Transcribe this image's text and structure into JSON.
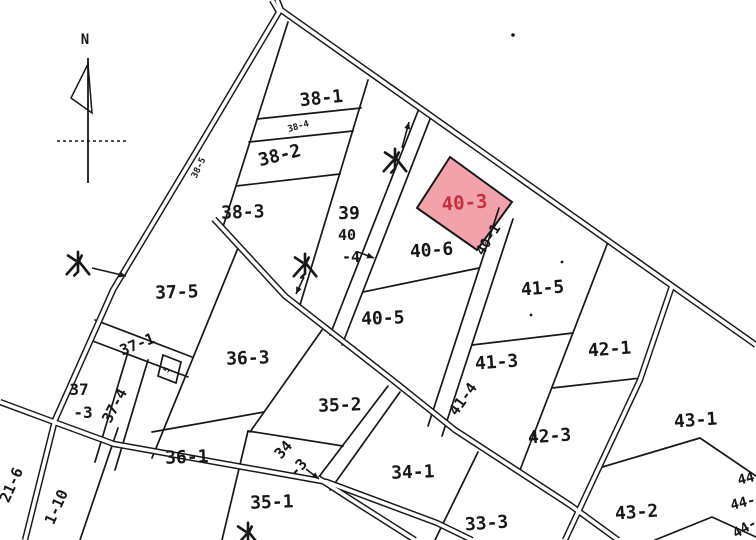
{
  "canvas": {
    "width": 756,
    "height": 540,
    "bg": "#ffffff",
    "ink": "#171717"
  },
  "compass": {
    "label": "N",
    "x": 85,
    "y": 44,
    "vline": [
      [
        88,
        58
      ],
      [
        88,
        183
      ]
    ],
    "flag": [
      [
        88,
        64
      ],
      [
        71,
        98
      ],
      [
        92,
        113
      ]
    ],
    "dash": [
      [
        57,
        141
      ],
      [
        127,
        141
      ]
    ]
  },
  "highlight": {
    "label": "40-3",
    "fill": "#F2A2AB",
    "stroke": "#171717",
    "text_color": "#C4303E",
    "polygon": [
      [
        450,
        157
      ],
      [
        512,
        202
      ],
      [
        477,
        250
      ],
      [
        417,
        208
      ]
    ],
    "label_x": 465,
    "label_y": 209,
    "label_rot": -4,
    "label_size": 19
  },
  "parcel_labels": [
    {
      "text": "38-1",
      "x": 322,
      "y": 104,
      "rot": -6,
      "size": 18
    },
    {
      "text": "38-4",
      "x": 299,
      "y": 129,
      "rot": -16,
      "size": 9
    },
    {
      "text": "38-2",
      "x": 281,
      "y": 161,
      "rot": -14,
      "size": 18
    },
    {
      "text": "38-3",
      "x": 243,
      "y": 218,
      "rot": -2,
      "size": 18
    },
    {
      "text": "38-5",
      "x": 201,
      "y": 169,
      "rot": -64,
      "size": 9
    },
    {
      "text": "39",
      "x": 349,
      "y": 219,
      "rot": 0,
      "size": 18
    },
    {
      "text": "40",
      "x": 347,
      "y": 240,
      "rot": 0,
      "size": 15
    },
    {
      "text": "-4",
      "x": 351,
      "y": 262,
      "rot": 0,
      "size": 15
    },
    {
      "text": "40-6",
      "x": 432,
      "y": 256,
      "rot": -4,
      "size": 18
    },
    {
      "text": "40-5",
      "x": 383,
      "y": 324,
      "rot": -2,
      "size": 18
    },
    {
      "text": "40-1",
      "x": 492,
      "y": 242,
      "rot": -58,
      "size": 14
    },
    {
      "text": "41-5",
      "x": 543,
      "y": 294,
      "rot": -4,
      "size": 18
    },
    {
      "text": "41-3",
      "x": 497,
      "y": 368,
      "rot": -4,
      "size": 18
    },
    {
      "text": "41-4",
      "x": 467,
      "y": 402,
      "rot": -54,
      "size": 15
    },
    {
      "text": "42-1",
      "x": 610,
      "y": 355,
      "rot": -4,
      "size": 18
    },
    {
      "text": "42-3",
      "x": 550,
      "y": 442,
      "rot": -4,
      "size": 18
    },
    {
      "text": "43-1",
      "x": 696,
      "y": 426,
      "rot": -4,
      "size": 18
    },
    {
      "text": "43-2",
      "x": 637,
      "y": 518,
      "rot": -4,
      "size": 18
    },
    {
      "text": "33-3",
      "x": 487,
      "y": 529,
      "rot": -4,
      "size": 18
    },
    {
      "text": "34-1",
      "x": 413,
      "y": 478,
      "rot": -2,
      "size": 18
    },
    {
      "text": "34",
      "x": 287,
      "y": 453,
      "rot": -48,
      "size": 15
    },
    {
      "text": "-3",
      "x": 302,
      "y": 471,
      "rot": -48,
      "size": 15
    },
    {
      "text": "35-2",
      "x": 340,
      "y": 411,
      "rot": -2,
      "size": 18
    },
    {
      "text": "35-1",
      "x": 272,
      "y": 508,
      "rot": -2,
      "size": 18
    },
    {
      "text": "36-3",
      "x": 248,
      "y": 364,
      "rot": -2,
      "size": 18
    },
    {
      "text": "36-1",
      "x": 187,
      "y": 463,
      "rot": -2,
      "size": 18
    },
    {
      "text": "37-5",
      "x": 177,
      "y": 298,
      "rot": -2,
      "size": 18
    },
    {
      "text": "37",
      "x": 79,
      "y": 395,
      "rot": 0,
      "size": 16
    },
    {
      "text": "-3",
      "x": 83,
      "y": 418,
      "rot": 0,
      "size": 16
    },
    {
      "text": "37-1",
      "x": 139,
      "y": 349,
      "rot": -22,
      "size": 15
    },
    {
      "text": "37-4",
      "x": 119,
      "y": 408,
      "rot": -62,
      "size": 15
    },
    {
      "text": "21-6",
      "x": 16,
      "y": 487,
      "rot": -66,
      "size": 15
    },
    {
      "text": "1-10",
      "x": 61,
      "y": 509,
      "rot": -66,
      "size": 15
    },
    {
      "text": "5",
      "x": 169,
      "y": 371,
      "rot": -60,
      "size": 8
    },
    {
      "text": "44",
      "x": 747,
      "y": 483,
      "rot": -14,
      "size": 14
    },
    {
      "text": "44-",
      "x": 744,
      "y": 507,
      "rot": -14,
      "size": 14
    },
    {
      "text": "44-",
      "x": 747,
      "y": 532,
      "rot": -30,
      "size": 14
    }
  ],
  "water_labels": [
    {
      "char": "水",
      "meaning": "water",
      "x": 395,
      "y": 160,
      "size": 1.25
    },
    {
      "char": "水",
      "meaning": "water",
      "x": 78,
      "y": 263,
      "size": 1.25
    },
    {
      "char": "水",
      "meaning": "water",
      "x": 305,
      "y": 265,
      "size": 1.25
    },
    {
      "char": "水",
      "meaning": "water",
      "x": 248,
      "y": 534,
      "size": 1.25
    }
  ],
  "channels": [
    {
      "name": "main-road-upper",
      "points": [
        [
          277,
          0
        ],
        [
          281,
          10
        ],
        [
          756,
          345
        ]
      ]
    },
    {
      "name": "left-channel",
      "points": [
        [
          272,
          0
        ],
        [
          279,
          12
        ],
        [
          197,
          150
        ],
        [
          113,
          290
        ],
        [
          55,
          420
        ],
        [
          25,
          540
        ]
      ]
    },
    {
      "name": "middle-channel",
      "points": [
        [
          214,
          219
        ],
        [
          285,
          296
        ],
        [
          390,
          378
        ],
        [
          455,
          430
        ],
        [
          570,
          505
        ],
        [
          618,
          540
        ]
      ]
    },
    {
      "name": "lower-left-channel",
      "points": [
        [
          0,
          402
        ],
        [
          54,
          422
        ],
        [
          114,
          444
        ],
        [
          327,
          482
        ],
        [
          437,
          523
        ],
        [
          472,
          540
        ]
      ]
    },
    {
      "name": "right-branch-road",
      "points": [
        [
          672,
          286
        ],
        [
          640,
          380
        ],
        [
          565,
          540
        ]
      ]
    },
    {
      "name": "bottom-center-channel",
      "points": [
        [
          318,
          478
        ],
        [
          352,
          500
        ],
        [
          415,
          540
        ]
      ]
    }
  ],
  "boundaries": [
    {
      "name": "b38-left",
      "points": [
        [
          288,
          22
        ],
        [
          222,
          230
        ]
      ]
    },
    {
      "name": "b38-39",
      "points": [
        [
          368,
          80
        ],
        [
          300,
          305
        ]
      ]
    },
    {
      "name": "strip40-4-left",
      "points": [
        [
          420,
          106
        ],
        [
          330,
          335
        ]
      ]
    },
    {
      "name": "strip40-4-right",
      "points": [
        [
          432,
          114
        ],
        [
          342,
          345
        ]
      ]
    },
    {
      "name": "strip40-1-left",
      "points": [
        [
          499,
          208
        ],
        [
          428,
          426
        ]
      ]
    },
    {
      "name": "strip40-1-right",
      "points": [
        [
          513,
          219
        ],
        [
          442,
          436
        ]
      ]
    },
    {
      "name": "b41-42",
      "points": [
        [
          608,
          242
        ],
        [
          520,
          470
        ]
      ]
    },
    {
      "name": "b34-33",
      "points": [
        [
          478,
          452
        ],
        [
          435,
          540
        ]
      ]
    },
    {
      "name": "strip34-3-right",
      "points": [
        [
          400,
          392
        ],
        [
          330,
          490
        ]
      ]
    },
    {
      "name": "strip34-3-left",
      "points": [
        [
          388,
          386
        ],
        [
          318,
          478
        ]
      ]
    },
    {
      "name": "b35-1-35-2",
      "points": [
        [
          248,
          431
        ],
        [
          343,
          446
        ]
      ]
    },
    {
      "name": "b36-1-35-1",
      "points": [
        [
          248,
          431
        ],
        [
          222,
          540
        ]
      ]
    },
    {
      "name": "b36-3-36-1",
      "points": [
        [
          152,
          432
        ],
        [
          264,
          412
        ]
      ]
    },
    {
      "name": "b36-3-35-2",
      "points": [
        [
          322,
          330
        ],
        [
          250,
          432
        ]
      ]
    },
    {
      "name": "b37-36",
      "points": [
        [
          238,
          248
        ],
        [
          152,
          458
        ]
      ]
    },
    {
      "name": "b42-1-42-3",
      "points": [
        [
          552,
          388
        ],
        [
          641,
          378
        ]
      ]
    },
    {
      "name": "b41-5-41-3",
      "points": [
        [
          472,
          345
        ],
        [
          573,
          333
        ]
      ]
    },
    {
      "name": "b38-1-38-4",
      "points": [
        [
          257,
          119
        ],
        [
          361,
          108
        ]
      ]
    },
    {
      "name": "b38-4-38-2",
      "points": [
        [
          249,
          142
        ],
        [
          353,
          131
        ]
      ]
    },
    {
      "name": "b38-2-38-3",
      "points": [
        [
          236,
          186
        ],
        [
          340,
          174
        ]
      ]
    },
    {
      "name": "b40-6-40-5",
      "points": [
        [
          363,
          292
        ],
        [
          479,
          268
        ]
      ]
    },
    {
      "name": "strip37-1-top",
      "points": [
        [
          95,
          320
        ],
        [
          192,
          357
        ]
      ]
    },
    {
      "name": "strip37-1-bottom",
      "points": [
        [
          90,
          340
        ],
        [
          188,
          377
        ]
      ]
    },
    {
      "name": "b43-1-bottom-a",
      "points": [
        [
          599,
          468
        ],
        [
          700,
          438
        ]
      ]
    },
    {
      "name": "b43-1-bottom-b",
      "points": [
        [
          700,
          438
        ],
        [
          756,
          476
        ]
      ]
    },
    {
      "name": "b44-row",
      "points": [
        [
          655,
          540
        ],
        [
          712,
          517
        ],
        [
          756,
          537
        ]
      ]
    },
    {
      "name": "strip1-10-right",
      "points": [
        [
          118,
          428
        ],
        [
          80,
          540
        ]
      ]
    },
    {
      "name": "strip37-4-left",
      "points": [
        [
          128,
          352
        ],
        [
          95,
          462
        ]
      ]
    },
    {
      "name": "strip37-4-right",
      "points": [
        [
          148,
          360
        ],
        [
          115,
          470
        ]
      ]
    },
    {
      "name": "tiny-parcel-box",
      "points": [
        [
          163,
          355
        ],
        [
          181,
          362
        ],
        [
          176,
          383
        ],
        [
          158,
          376
        ]
      ],
      "closed": true
    }
  ],
  "arrows": [
    {
      "name": "water-left-arrow",
      "points": [
        [
          92,
          268
        ],
        [
          126,
          276
        ]
      ]
    },
    {
      "name": "water-mid-arrow",
      "points": [
        [
          304,
          277
        ],
        [
          296,
          294
        ]
      ]
    },
    {
      "name": "water-top-leader",
      "points": [
        [
          402,
          148
        ],
        [
          409,
          122
        ]
      ]
    },
    {
      "name": "label40-4-arrow",
      "points": [
        [
          358,
          252
        ],
        [
          374,
          258
        ]
      ]
    },
    {
      "name": "label34-3-arrow",
      "points": [
        [
          306,
          469
        ],
        [
          319,
          479
        ]
      ]
    }
  ],
  "dots": [
    {
      "x": 513,
      "y": 35,
      "r": 1.8
    },
    {
      "x": 562,
      "y": 262,
      "r": 1.4
    },
    {
      "x": 531,
      "y": 315,
      "r": 1.4
    }
  ]
}
